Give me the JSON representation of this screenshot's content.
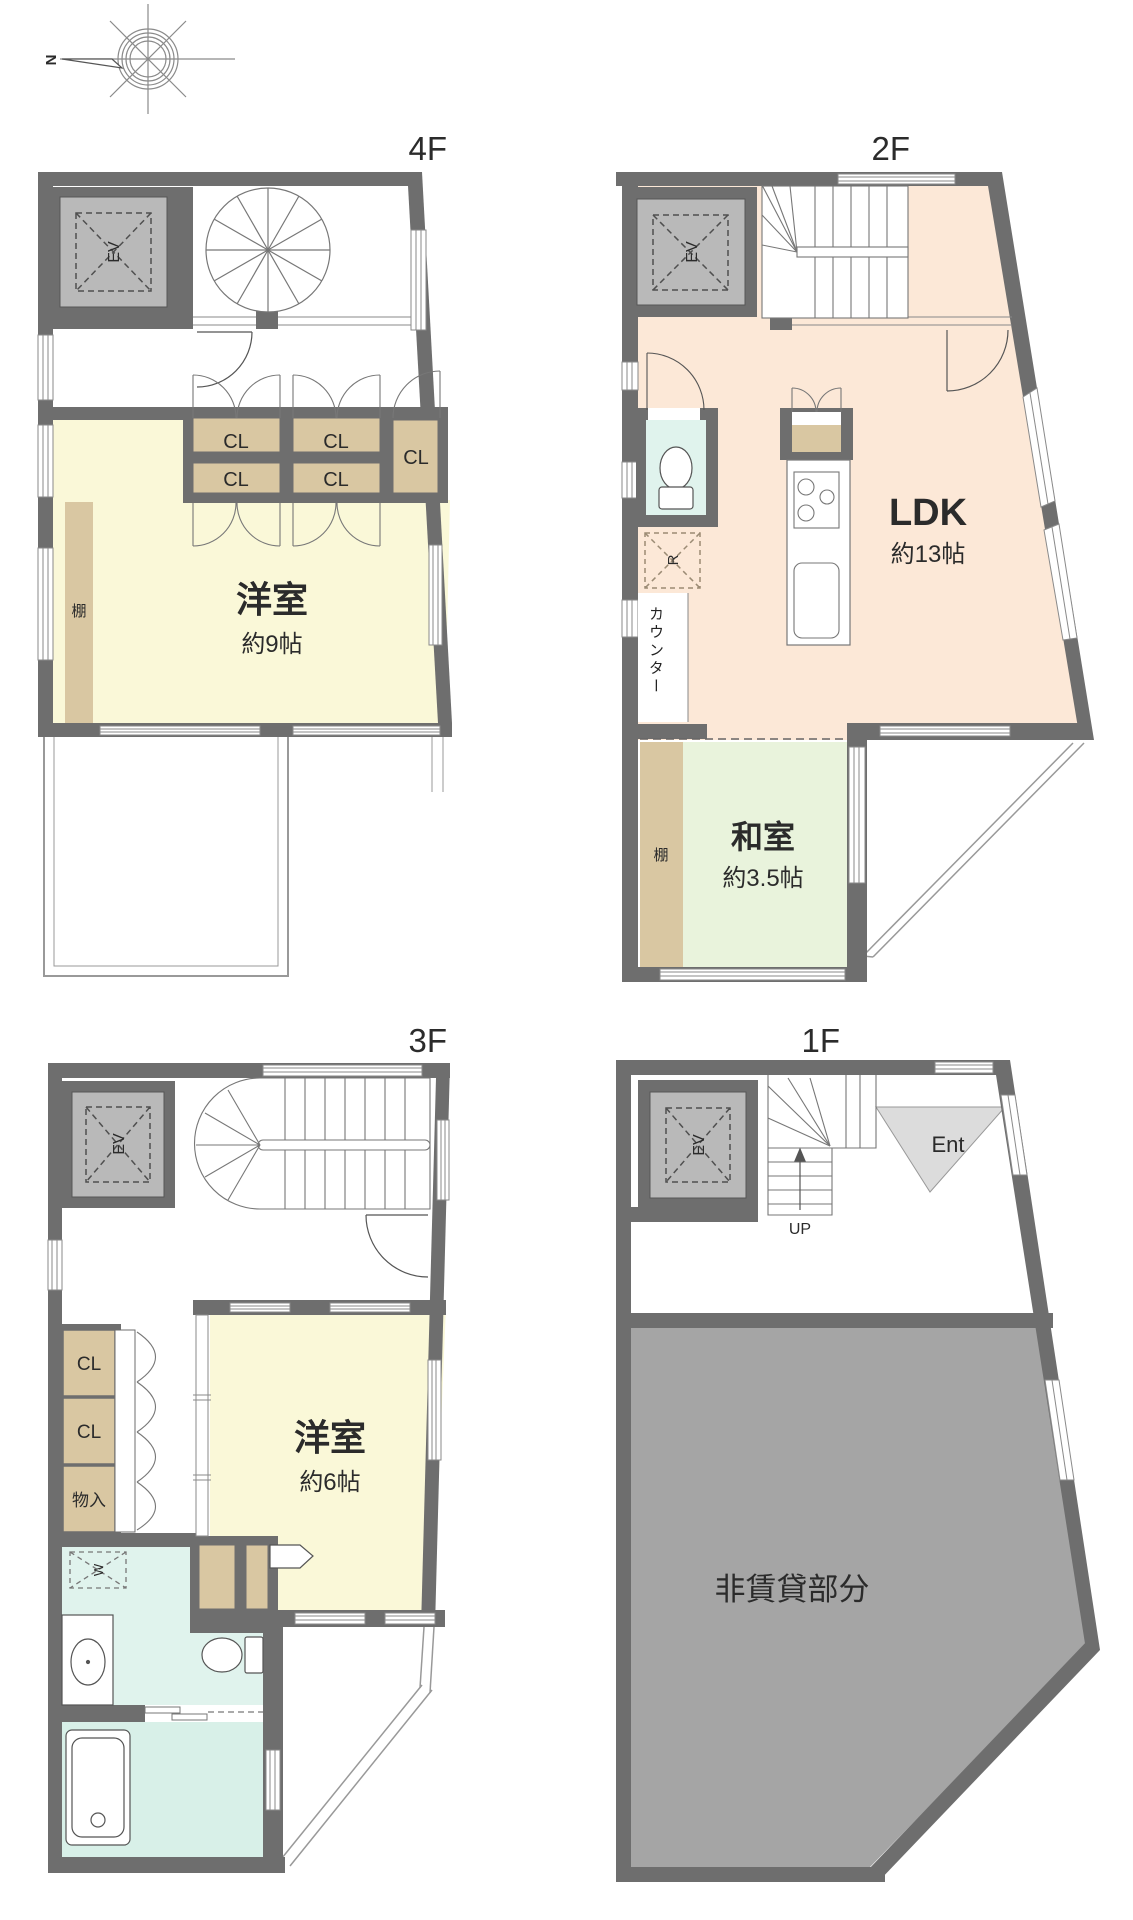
{
  "compass": {
    "north": "N"
  },
  "floor_4f": {
    "label": "4F",
    "ev": "EV",
    "closets": [
      "CL",
      "CL",
      "CL",
      "CL",
      "CL"
    ],
    "shelf": "棚",
    "room": {
      "name": "洋室",
      "size": "約9帖"
    }
  },
  "floor_2f": {
    "label": "2F",
    "ev": "EV",
    "fridge": "R",
    "counter": "カウンター",
    "ldk": {
      "name": "LDK",
      "size": "約13帖"
    },
    "washitsu": {
      "name": "和室",
      "size": "約3.5帖"
    },
    "shelf": "棚"
  },
  "floor_3f": {
    "label": "3F",
    "ev": "EV",
    "closets": [
      "CL",
      "CL"
    ],
    "storage": "物入",
    "washer": "W",
    "room": {
      "name": "洋室",
      "size": "約6帖"
    }
  },
  "floor_1f": {
    "label": "1F",
    "ev": "EV",
    "up": "UP",
    "entrance": "Ent",
    "non_rental": "非賃貸部分"
  },
  "colors": {
    "wall": "#6e6e6e",
    "room_yellow": "#faf8d8",
    "room_peach": "#fce8d7",
    "room_green": "#e9f3dc",
    "room_mint": "#e0f3ed",
    "room_bath": "#d8f0e8",
    "closet_tan": "#d9c7a2",
    "ev_gray": "#b9b9b9",
    "non_rental_gray": "#a5a5a5",
    "entrance_gray": "#dcdcdc"
  }
}
